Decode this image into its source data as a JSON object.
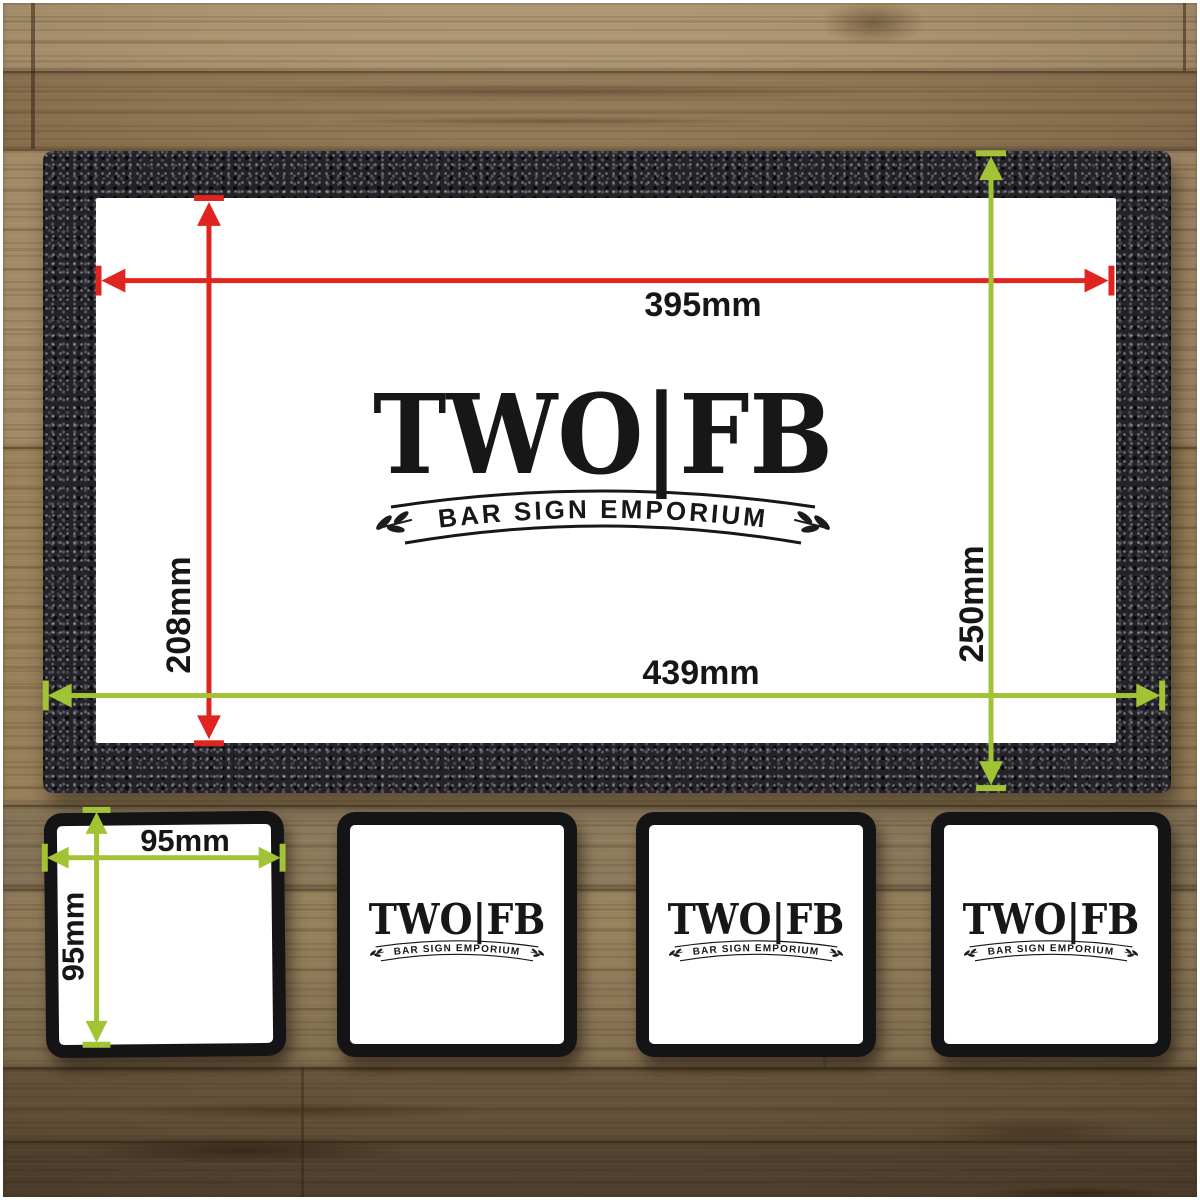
{
  "logo": {
    "title": "TWO|FB",
    "subtitle": "BAR SIGN EMPORIUM"
  },
  "bar_runner": {
    "inner_width": "395mm",
    "inner_height": "208mm",
    "outer_width": "439mm",
    "outer_height": "250mm"
  },
  "coaster": {
    "width": "95mm",
    "height": "95mm"
  },
  "colors": {
    "inner_dimension_arrows": "#e02420",
    "outer_dimension_arrows": "#a2c336",
    "mat_border": "#232327",
    "print_area": "#ffffff",
    "logo_ink": "#171717"
  }
}
